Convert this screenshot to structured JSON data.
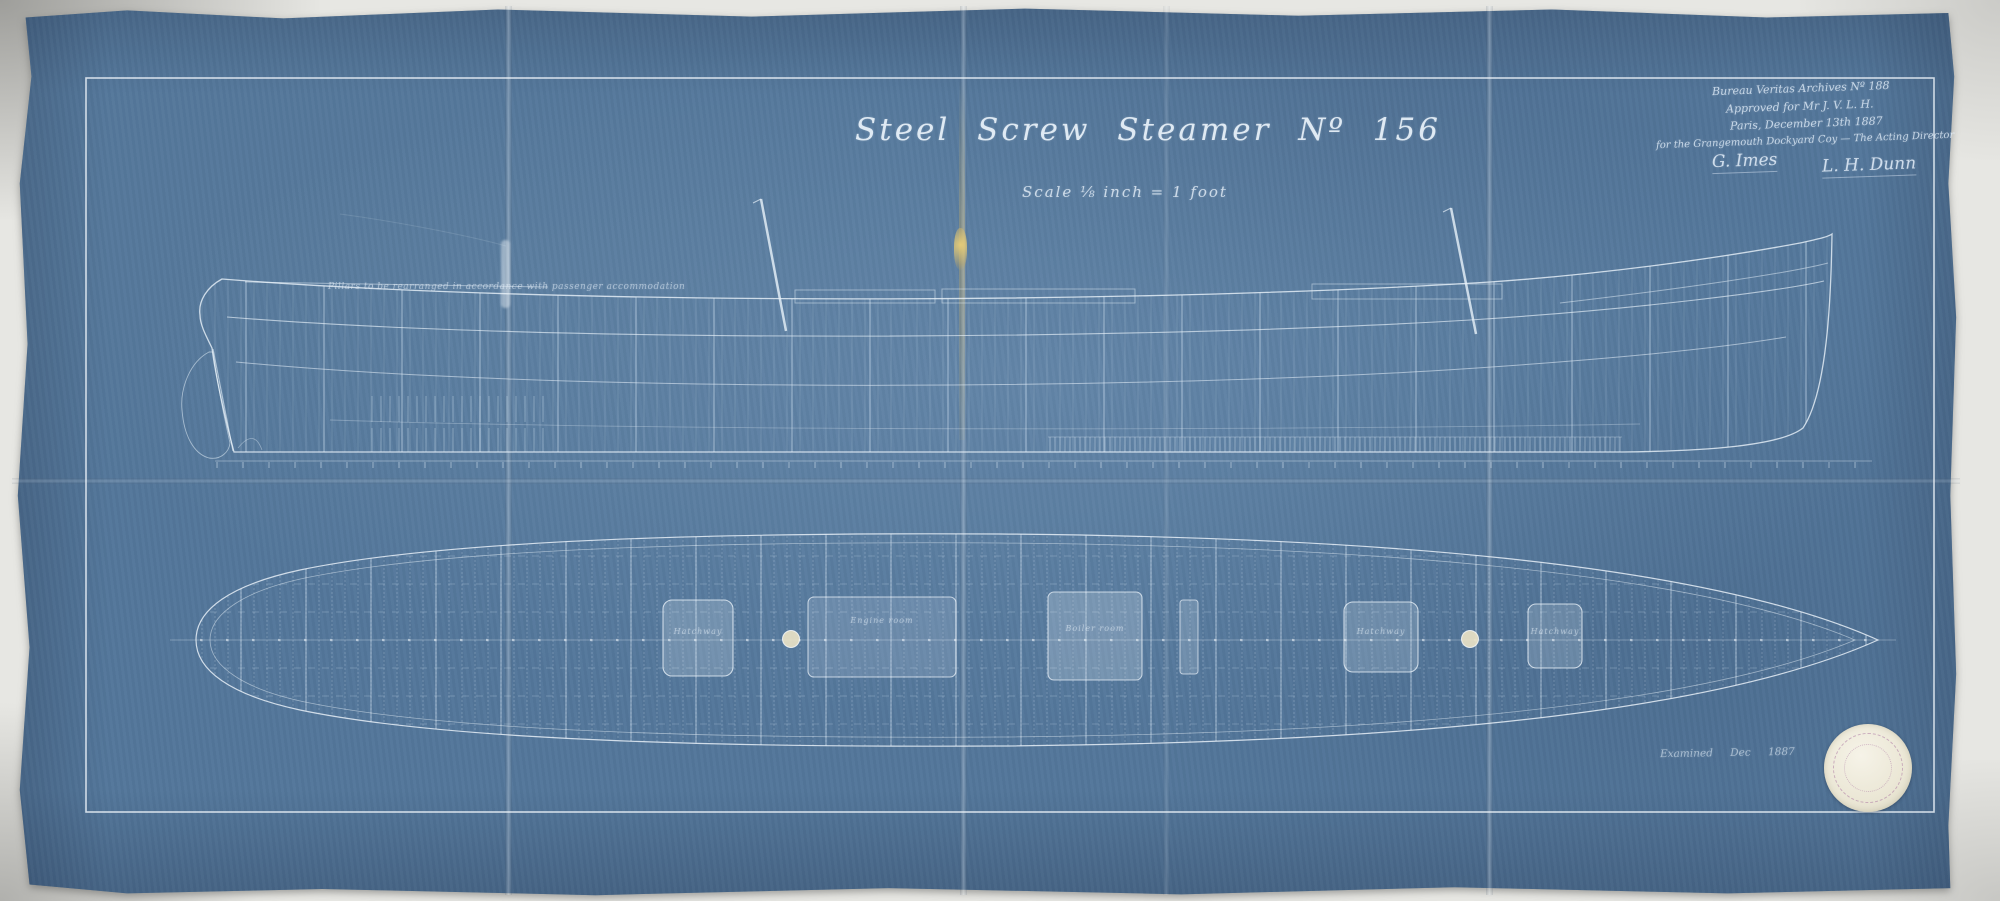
{
  "doc": {
    "title": "Steel Screw Steamer Nº 156",
    "scale_note": "Scale ⅛ inch = 1 foot",
    "hull_annotation": "Pillars to be rearranged in accordance with passenger accommodation",
    "date_note": "Examined Dec 1887"
  },
  "approval": {
    "lines": [
      "Bureau Veritas Archives Nº 188",
      "Approved for Mr J. V. L. H.",
      "Paris, December 13th 1887",
      "for the Grangemouth Dockyard Coy — The Acting Director"
    ],
    "signatures": [
      "G. Imes",
      "L. H. Dunn"
    ]
  },
  "plan": {
    "hatch_labels": [
      "Hatchway",
      "Engine room",
      "Boiler room",
      "Hatchway",
      "Hatchway"
    ]
  },
  "colors": {
    "paper_blue": "#53769a",
    "line_white": "#dce8f2",
    "backdrop_gray": "#e7e7e3",
    "crease_gold": "#c9ae6f",
    "seal_cream": "#efecdd",
    "seal_ink": "#9b6fa0"
  }
}
